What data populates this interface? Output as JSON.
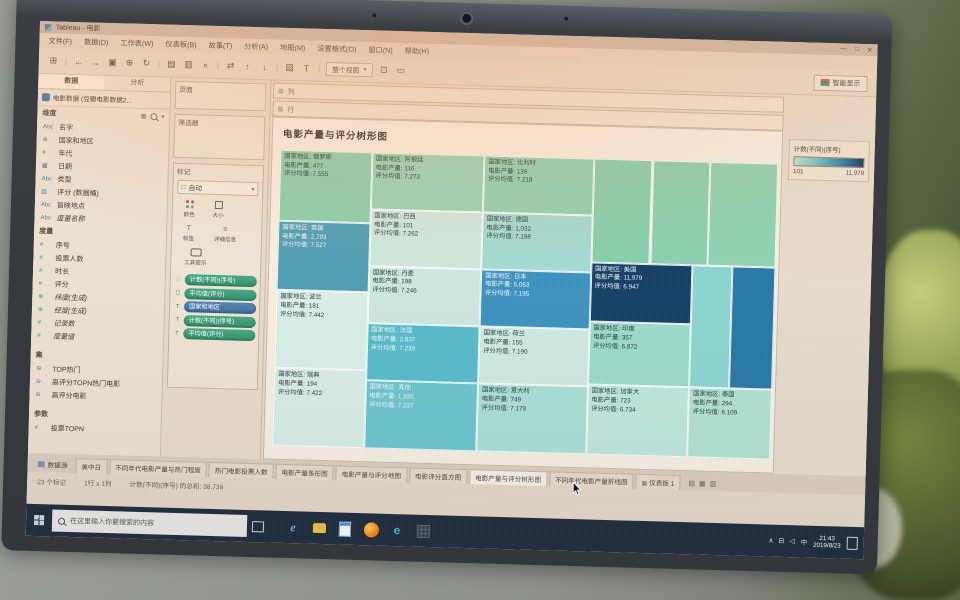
{
  "window": {
    "title": "Tableau - 电影",
    "controls": [
      {
        "name": "minimize",
        "glyph": "—"
      },
      {
        "name": "maximize",
        "glyph": "□"
      },
      {
        "name": "close",
        "glyph": "✕"
      }
    ]
  },
  "menu": {
    "items": [
      "文件(F)",
      "数据(D)",
      "工作表(W)",
      "仪表板(B)",
      "故事(T)",
      "分析(A)",
      "地图(M)",
      "设置格式(O)",
      "窗口(N)",
      "帮助(H)"
    ]
  },
  "toolbar": {
    "icons": [
      {
        "name": "tableau-logo",
        "glyph": "⊞"
      },
      {
        "name": "sep",
        "glyph": "|"
      },
      {
        "name": "back",
        "glyph": "←"
      },
      {
        "name": "forward",
        "glyph": "→"
      },
      {
        "name": "save",
        "glyph": "▣"
      },
      {
        "name": "add-data",
        "glyph": "⊕"
      },
      {
        "name": "refresh",
        "glyph": "↻"
      },
      {
        "name": "sep",
        "glyph": "|"
      },
      {
        "name": "new-worksheet",
        "glyph": "▤"
      },
      {
        "name": "duplicate",
        "glyph": "▥"
      },
      {
        "name": "clear-sheet",
        "glyph": "×"
      },
      {
        "name": "sep",
        "glyph": "|"
      },
      {
        "name": "swap-axes",
        "glyph": "⇄"
      },
      {
        "name": "sort-ascending",
        "glyph": "↑"
      },
      {
        "name": "sort-descending",
        "glyph": "↓"
      },
      {
        "name": "sep",
        "glyph": "|"
      },
      {
        "name": "highlight",
        "glyph": "▨"
      },
      {
        "name": "show-labels",
        "glyph": "T"
      },
      {
        "name": "sep",
        "glyph": "|"
      }
    ],
    "fit_value": "整个视图",
    "fit_caret": "▾",
    "after_icons": [
      {
        "name": "fix-axes",
        "glyph": "⊡"
      },
      {
        "name": "presentation-mode",
        "glyph": "▭"
      }
    ],
    "showme_label": "智能显示"
  },
  "data_pane": {
    "tabs": [
      {
        "label": "数据",
        "active": true
      },
      {
        "label": "分析",
        "active": false
      }
    ],
    "source": "电影数据 (豆瓣电影数据2...",
    "dimensions_header": "维度",
    "measures_header": "度量",
    "sets_header": "集",
    "parameters_header": "参数",
    "dimensions": [
      {
        "icon": "abc",
        "label": "名字",
        "color": "blue"
      },
      {
        "icon": "globe",
        "label": "国家和地区",
        "color": "blue"
      },
      {
        "icon": "num",
        "label": "年代",
        "color": "blue"
      },
      {
        "icon": "calendar",
        "label": "日期",
        "color": "blue"
      },
      {
        "icon": "abc",
        "label": "类型",
        "color": "blue"
      },
      {
        "icon": "bins",
        "label": "评分 (数据桶)",
        "color": "blue"
      },
      {
        "icon": "abc",
        "label": "首映地点",
        "color": "blue"
      },
      {
        "icon": "abc",
        "label": "度量名称",
        "color": "blue",
        "italic": true
      }
    ],
    "measures": [
      {
        "icon": "num",
        "label": "序号",
        "color": "green"
      },
      {
        "icon": "num",
        "label": "投票人数",
        "color": "green"
      },
      {
        "icon": "num",
        "label": "时长",
        "color": "green"
      },
      {
        "icon": "num",
        "label": "评分",
        "color": "green"
      },
      {
        "icon": "globe",
        "label": "纬度(生成)",
        "color": "green",
        "italic": true
      },
      {
        "icon": "globe",
        "label": "经度(生成)",
        "color": "green",
        "italic": true
      },
      {
        "icon": "num",
        "label": "记录数",
        "color": "green",
        "italic": true
      },
      {
        "icon": "num",
        "label": "度量值",
        "color": "green",
        "italic": true
      }
    ],
    "sets": [
      {
        "icon": "venn",
        "label": "TOP热门",
        "color": "blue"
      },
      {
        "icon": "venn",
        "label": "高评分TOPN热门电影",
        "color": "blue"
      },
      {
        "icon": "venn",
        "label": "高评分电影",
        "color": "blue"
      }
    ],
    "parameters": [
      {
        "icon": "num",
        "label": "投票TOPN",
        "color": "gray"
      }
    ]
  },
  "cards": {
    "pages_label": "页面",
    "filters_label": "筛选器",
    "marks_label": "标记",
    "mark_type": "自动",
    "buttons": [
      {
        "name": "color",
        "label": "颜色"
      },
      {
        "name": "size",
        "label": "大小"
      },
      {
        "name": "label",
        "label": "标签"
      },
      {
        "name": "detail",
        "label": "详细信息"
      },
      {
        "name": "tooltip",
        "label": "工具提示"
      }
    ],
    "pills": [
      {
        "label": "计数(不同)(序号)",
        "color": "green",
        "icon": "color"
      },
      {
        "label": "平均值(评分)",
        "color": "green",
        "icon": "size"
      },
      {
        "label": "国家和地区",
        "color": "blue",
        "icon": "label"
      },
      {
        "label": "计数(不同)(序号)",
        "color": "green",
        "icon": "label"
      },
      {
        "label": "平均值(评分)",
        "color": "green",
        "icon": "label"
      }
    ]
  },
  "shelves": {
    "columns_label": "列",
    "rows_label": "行"
  },
  "chart_data": {
    "type": "treemap",
    "title": "电影产量与评分树形图",
    "size_by": "平均值(评分)",
    "color_by": "计数(不同)(序号)",
    "row_labels": {
      "country": "国家地区",
      "production": "电影产量",
      "rating": "评分均值"
    },
    "legend": {
      "title": "计数(不同)(序号)",
      "min": "101",
      "max": "11,979"
    },
    "cells": [
      {
        "country": "俄罗斯",
        "production": "477",
        "rating": "7.555",
        "x": 0,
        "y": 0,
        "w": 18.4,
        "h": 24,
        "color": "#8ccfad",
        "text": "dark"
      },
      {
        "country": "英国",
        "production": "2,793",
        "rating": "7.527",
        "x": 0,
        "y": 24,
        "w": 18.4,
        "h": 23.4,
        "color": "#4f9fb4",
        "text": "light"
      },
      {
        "country": "波兰",
        "production": "181",
        "rating": "7.442",
        "x": 0,
        "y": 47.4,
        "w": 18.4,
        "h": 26.3,
        "color": "#dcefe8",
        "text": "dark"
      },
      {
        "country": "瑞典",
        "production": "194",
        "rating": "7.422",
        "x": 0,
        "y": 73.7,
        "w": 18.4,
        "h": 26.3,
        "color": "#daeee7",
        "text": "dark"
      },
      {
        "country": "阿根廷",
        "production": "116",
        "rating": "7.273",
        "x": 18.4,
        "y": 0,
        "w": 22.6,
        "h": 19.2,
        "color": "#98d4b6",
        "text": "dark"
      },
      {
        "country": "巴西",
        "production": "101",
        "rating": "7.262",
        "x": 18.4,
        "y": 19.2,
        "w": 22.6,
        "h": 19.2,
        "color": "#cfe9dd",
        "text": "dark"
      },
      {
        "country": "丹麦",
        "production": "198",
        "rating": "7.246",
        "x": 18.4,
        "y": 38.4,
        "w": 22.6,
        "h": 19.5,
        "color": "#cde9e0",
        "text": "dark"
      },
      {
        "country": "法国",
        "production": "2,837",
        "rating": "7.239",
        "x": 18.4,
        "y": 57.9,
        "w": 22.6,
        "h": 19.2,
        "color": "#58bcca",
        "text": "light"
      },
      {
        "country": "其他",
        "production": "1,920",
        "rating": "7.237",
        "x": 18.4,
        "y": 77.1,
        "w": 22.6,
        "h": 22.9,
        "color": "#6cc6cf",
        "text": "light"
      },
      {
        "country": "比利时",
        "production": "139",
        "rating": "7.218",
        "x": 41,
        "y": 0,
        "w": 22,
        "h": 19.2,
        "color": "#92d2b2",
        "text": "dark"
      },
      {
        "country": "德国",
        "production": "1,032",
        "rating": "7.198",
        "x": 41,
        "y": 19.2,
        "w": 22,
        "h": 19.2,
        "color": "#a4dbd2",
        "text": "dark"
      },
      {
        "country": "日本",
        "production": "5,053",
        "rating": "7.195",
        "x": 41,
        "y": 38.4,
        "w": 22,
        "h": 19.5,
        "color": "#3c93bf",
        "text": "light"
      },
      {
        "country": "荷兰",
        "production": "155",
        "rating": "7.190",
        "x": 41,
        "y": 57.9,
        "w": 22,
        "h": 19.2,
        "color": "#cfebe2",
        "text": "dark"
      },
      {
        "country": "意大利",
        "production": "749",
        "rating": "7.179",
        "x": 41,
        "y": 77.1,
        "w": 22,
        "h": 22.9,
        "color": "#abe0d6",
        "text": "dark"
      },
      {
        "country": "",
        "production": "",
        "rating": "",
        "x": 63,
        "y": 0,
        "w": 11.8,
        "h": 35,
        "color": "#86cfab",
        "text": "dark"
      },
      {
        "country": "",
        "production": "",
        "rating": "",
        "x": 74.8,
        "y": 0,
        "w": 11.6,
        "h": 35,
        "color": "#8ad1ae",
        "text": "dark"
      },
      {
        "country": "",
        "production": "",
        "rating": "",
        "x": 86.4,
        "y": 0,
        "w": 13.6,
        "h": 35,
        "color": "#90d3b1",
        "text": "dark"
      },
      {
        "country": "美国",
        "production": "11,979",
        "rating": "6.947",
        "x": 63,
        "y": 35,
        "w": 20.4,
        "h": 20.2,
        "color": "#153f66",
        "text": "light"
      },
      {
        "country": "印度",
        "production": "357",
        "rating": "6.872",
        "x": 63,
        "y": 55.2,
        "w": 20.4,
        "h": 21.2,
        "color": "#9cdccc",
        "text": "dark"
      },
      {
        "country": "加拿大",
        "production": "723",
        "rating": "6.734",
        "x": 63,
        "y": 76.4,
        "w": 20.4,
        "h": 23.6,
        "color": "#bfe8dc",
        "text": "dark"
      },
      {
        "country": "",
        "production": "",
        "rating": "",
        "x": 83.4,
        "y": 35,
        "w": 8,
        "h": 41.4,
        "color": "#8cd6d0",
        "text": "dark"
      },
      {
        "country": "",
        "production": "",
        "rating": "",
        "x": 91.4,
        "y": 35,
        "w": 8.6,
        "h": 41.4,
        "color": "#2978a6",
        "text": "light"
      },
      {
        "country": "泰国",
        "production": "294",
        "rating": "6.109",
        "x": 83.4,
        "y": 76.4,
        "w": 16.6,
        "h": 23.6,
        "color": "#b2e3d0",
        "text": "dark"
      }
    ]
  },
  "tabs_bar": {
    "datasource_label": "数据源",
    "tabs": [
      {
        "label": "美中日"
      },
      {
        "label": "不同年代电影产量与热门程度"
      },
      {
        "label": "热门电影投票人数"
      },
      {
        "label": "电影产量条形图"
      },
      {
        "label": "电影产量与评分地图"
      },
      {
        "label": "电影评分直方图"
      },
      {
        "label": "电影产量与评分树形图",
        "active": true
      },
      {
        "label": "不同年代电影产量折线图"
      },
      {
        "label": "仪表板 1",
        "dashboard": true
      }
    ],
    "new_buttons": [
      {
        "name": "new-worksheet",
        "glyph": "▤"
      },
      {
        "name": "new-dashboard",
        "glyph": "▦"
      },
      {
        "name": "new-story",
        "glyph": "▥"
      }
    ]
  },
  "status_bar": {
    "marks": "23 个标记",
    "grid": "1行 x 1列",
    "aggregate": "计数(不同)(序号) 的总和: 38,738"
  },
  "taskbar": {
    "search_placeholder": "在这里输入你要搜索的内容",
    "apps": [
      {
        "name": "ie",
        "glyph": "e"
      },
      {
        "name": "explorer",
        "glyph": ""
      },
      {
        "name": "wps",
        "glyph": ""
      },
      {
        "name": "firefox",
        "glyph": ""
      },
      {
        "name": "edge",
        "glyph": "e"
      },
      {
        "name": "grid",
        "glyph": ""
      }
    ],
    "tray": {
      "icons": [
        {
          "name": "hidden-icons",
          "glyph": "∧"
        },
        {
          "name": "network",
          "glyph": "⊟"
        },
        {
          "name": "volume",
          "glyph": "◁"
        }
      ],
      "lang": "中",
      "time": "21:43",
      "date": "2019/8/23"
    }
  }
}
